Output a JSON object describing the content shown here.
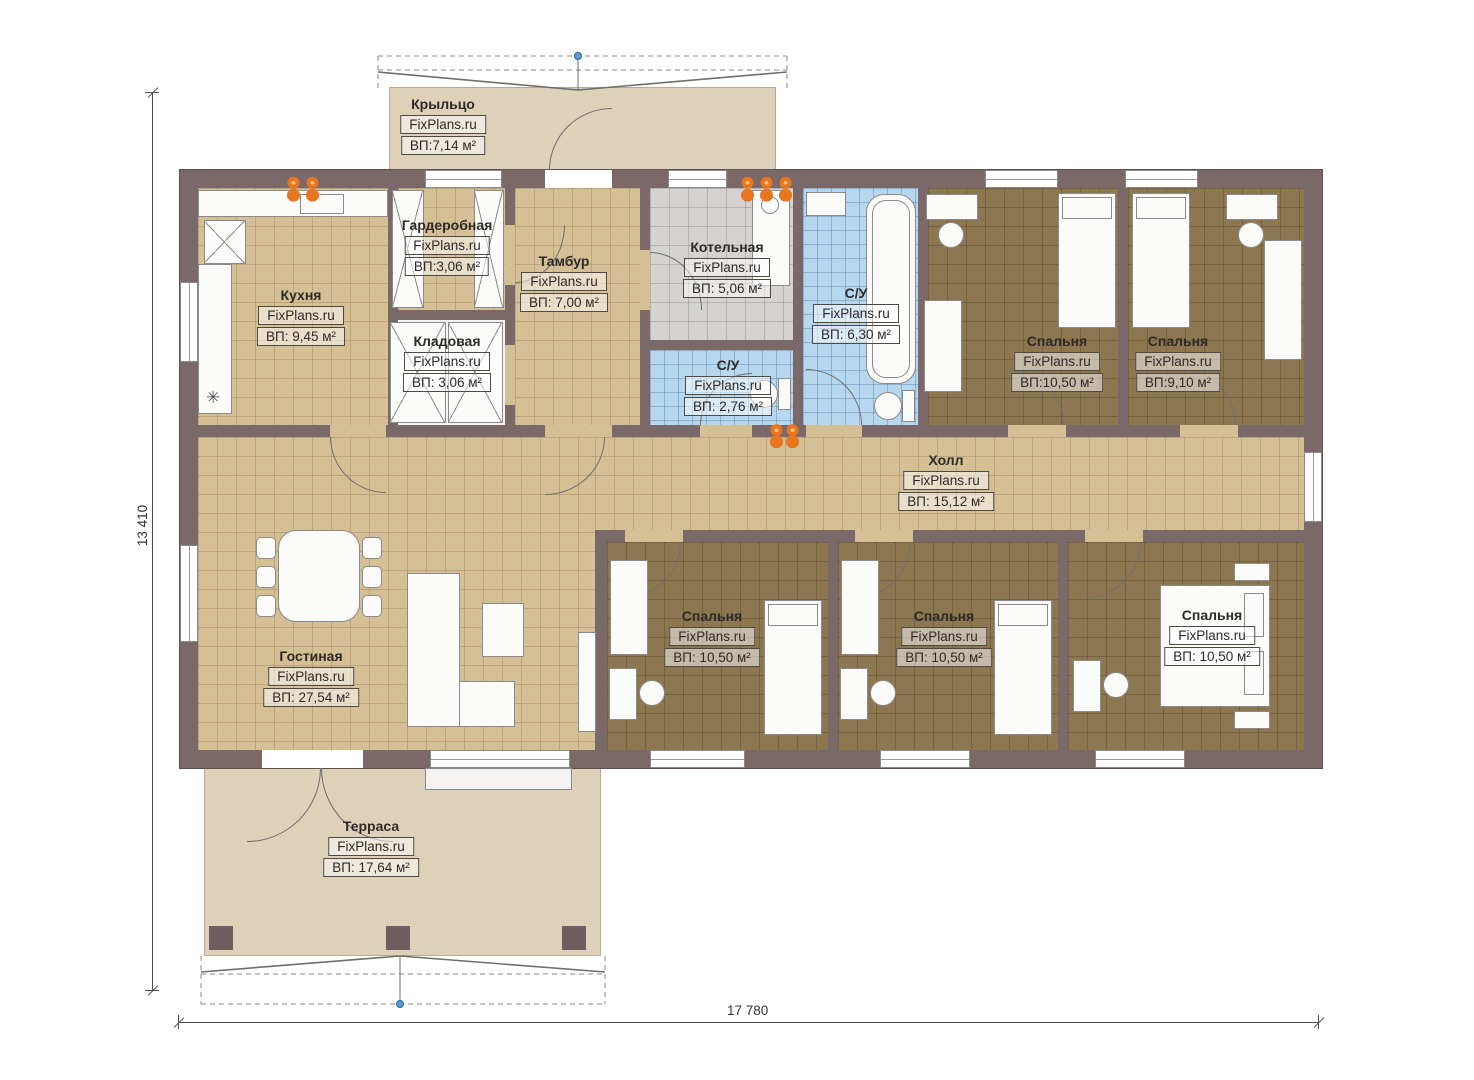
{
  "brand": "FixPlans.ru",
  "plan": {
    "rooms": [
      {
        "id": "kryltso",
        "name": "Крыльцо",
        "area": "ВП:7,14 м²"
      },
      {
        "id": "garderobnaya",
        "name": "Гардеробная",
        "area": "ВП:3,06 м²"
      },
      {
        "id": "tambur",
        "name": "Тамбур",
        "area": "ВП: 7,00 м²"
      },
      {
        "id": "kotelnaya",
        "name": "Котельная",
        "area": "ВП: 5,06 м²"
      },
      {
        "id": "su_big",
        "name": "С/У",
        "area": "ВП: 6,30 м²"
      },
      {
        "id": "kuhnya",
        "name": "Кухня",
        "area": "ВП: 9,45 м²"
      },
      {
        "id": "kladovaya",
        "name": "Кладовая",
        "area": "ВП: 3,06 м²"
      },
      {
        "id": "su_small",
        "name": "С/У",
        "area": "ВП: 2,76 м²"
      },
      {
        "id": "bedroom_top1",
        "name": "Спальня",
        "area": "ВП:10,50 м²"
      },
      {
        "id": "bedroom_top2",
        "name": "Спальня",
        "area": "ВП:9,10 м²"
      },
      {
        "id": "holl",
        "name": "Холл",
        "area": "ВП: 15,12 м²"
      },
      {
        "id": "gostinaya",
        "name": "Гостиная",
        "area": "ВП: 27,54 м²"
      },
      {
        "id": "bedroom_b1",
        "name": "Спальня",
        "area": "ВП: 10,50 м²"
      },
      {
        "id": "bedroom_b2",
        "name": "Спальня",
        "area": "ВП: 10,50 м²"
      },
      {
        "id": "bedroom_b3",
        "name": "Спальня",
        "area": "ВП: 10,50 м²"
      },
      {
        "id": "terrasa",
        "name": "Терраса",
        "area": "ВП: 17,64 м²"
      }
    ],
    "dimensions": {
      "left": "13 410",
      "bottom": "17 780"
    }
  },
  "glyphs": {
    "fridge": "✳"
  },
  "colors": {
    "wall": "#7b696a",
    "wall_dark": "#5e4f51",
    "floor_beige": "#d5bf94",
    "floor_brown": "#8d7751",
    "floor_blue": "#b7d7ef",
    "floor_gray": "#d5d3d1",
    "outdoor": "#ddd1ba",
    "accent_orange": "#e8761f",
    "marker_blue": "#5b9bd5",
    "label_text": "#2e2a28"
  }
}
